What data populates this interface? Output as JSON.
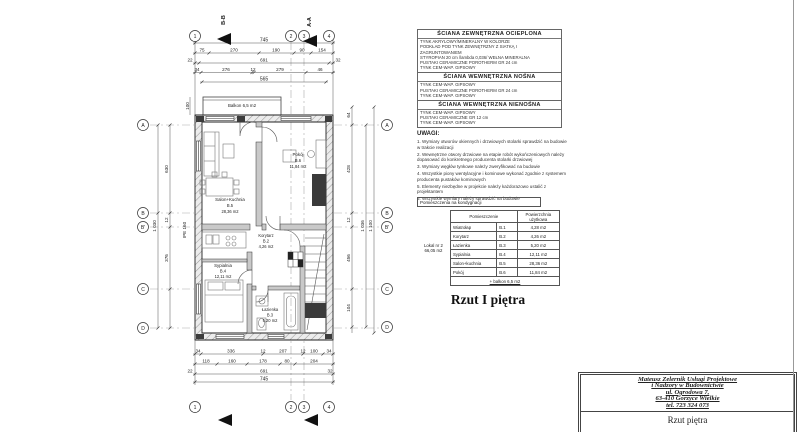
{
  "drawing": {
    "title": "Rzut I piętra"
  },
  "legend": {
    "sections": [
      {
        "title": "ŚCIANA ZEWNĘTRZNA OCIEPLONA",
        "lines": [
          "TYNK AKRYLOWY/MINERALNY W KOLORZE",
          "PODKŁAD POD TYNK ZEWNĘTRZNY Z SIATKĄ I ZAGRUNTOWANIEM",
          "STYROPIAN 20 cm /lambda 0,036/ WEŁNA MINERALNA",
          "PUSTAKI CERAMICZNE POROTHERM GR 24 cm",
          "TYNK CEM-WAP. GIPSOWY"
        ]
      },
      {
        "title": "ŚCIANA WEWNĘTRZNA NOŚNA",
        "lines": [
          "TYNK CEM-WAP. GIPSOWY",
          "PUSTAKI CERAMICZNE POROTHERM GR 24 cm",
          "TYNK CEM-WAP. GIPSOWY"
        ]
      },
      {
        "title": "ŚCIANA WEWNĘTRZNA NIENOŚNA",
        "lines": [
          "TYNK CEM-WAP. GIPSOWY",
          "PUSTAKI CERAMICZNE GR 12 cm",
          "TYNK CEM-WAP. GIPSOWY"
        ]
      }
    ]
  },
  "notes": {
    "title": "UWAGI:",
    "items": [
      "1. Wymiary otworów okiennych i drzwiowych stolarki sprawdzić na budowie w trakcie realizacji",
      "2. Wewnętrzne otwory drzwiowe na etapie robót wykończeniowych należy dopasować do konkretnego producenta stolarki drzwiowej",
      "3. Wymiary węgłów tynkowe należy zweryfikować na budowie",
      "4. Wszystkie piony wentylacyjne i kominowe wykonać zgodnie z systemem producenta pustaków kominowych",
      "5. Elementy niezbędne w projekcie należy każdorazowo ustalić z projektantem",
      "6. Wszystkie wymiary należy sprawdzić na budowie"
    ]
  },
  "room_table": {
    "header": "Pomieszczenia na kondygnacji",
    "col_room": "Pomieszczenie",
    "col_area": "Powierzchnia użytkowa",
    "unit": {
      "name": "Lokal nr 2",
      "area": "66,05 m2"
    },
    "rows": [
      {
        "name": "Wiatrołap",
        "no": "B.1",
        "area": "4,28 m2"
      },
      {
        "name": "Korytarz",
        "no": "B.2",
        "area": "4,26 m2"
      },
      {
        "name": "Łazienka",
        "no": "B.3",
        "area": "5,20 m2"
      },
      {
        "name": "Sypialnia",
        "no": "B.4",
        "area": "12,11 m2"
      },
      {
        "name": "Salon+kuchnia",
        "no": "B.5",
        "area": "28,36 m2"
      },
      {
        "name": "Pokój",
        "no": "B.6",
        "area": "11,84 m2"
      }
    ],
    "footer": "+ balkon 6,5 m2"
  },
  "title_block": {
    "company_lines": [
      "Mateusz Zelernik Usługi Projektowe",
      "i Nadzory w Budownictwie",
      "ul. Ogrodowa 7,",
      "63-410 Gorzyce Wielkie",
      "tel. 723 324 073"
    ],
    "drawing_name": "Rzut piętra"
  },
  "plan": {
    "balkon_label": "Balkon 6,5 m2",
    "beam_label": "IPE 160",
    "rooms": [
      {
        "name": "Salon+Kuchnia",
        "no": "B.5",
        "area": "28,36 m2"
      },
      {
        "name": "Pokój",
        "no": "B.6",
        "area": "11,84 m2"
      },
      {
        "name": "Korytarz",
        "no": "B.2",
        "area": "4,26 m2"
      },
      {
        "name": "Sypialnia",
        "no": "B.4",
        "area": "12,11 m2"
      },
      {
        "name": "Łazienka",
        "no": "B.3",
        "area": "5,20 m2"
      }
    ],
    "grid": {
      "cols": [
        "1",
        "2",
        "3",
        "4"
      ],
      "rows": [
        "A",
        "B",
        "B'",
        "C",
        "D"
      ]
    },
    "sections": [
      "B-B",
      "A-A"
    ],
    "dims": {
      "top1": [
        "745"
      ],
      "top2": [
        "75",
        "270",
        "190",
        "90",
        "154"
      ],
      "top3": [
        "22",
        "691",
        "32"
      ],
      "top4": [
        "34",
        "276",
        "12",
        "279",
        "46"
      ],
      "top5": [
        "565"
      ],
      "bot1": [
        "34",
        "336",
        "12",
        "207",
        "12",
        "100",
        "34"
      ],
      "bot2": [
        "118",
        "160",
        "178",
        "80",
        "204"
      ],
      "bot3": [
        "22",
        "691",
        "32"
      ],
      "bot4": [
        "745"
      ],
      "left": [
        "100",
        "630",
        "12",
        "376",
        "1 030"
      ],
      "right": [
        "64",
        "428",
        "12",
        "456",
        "104",
        "1 036",
        "1 100"
      ]
    }
  }
}
